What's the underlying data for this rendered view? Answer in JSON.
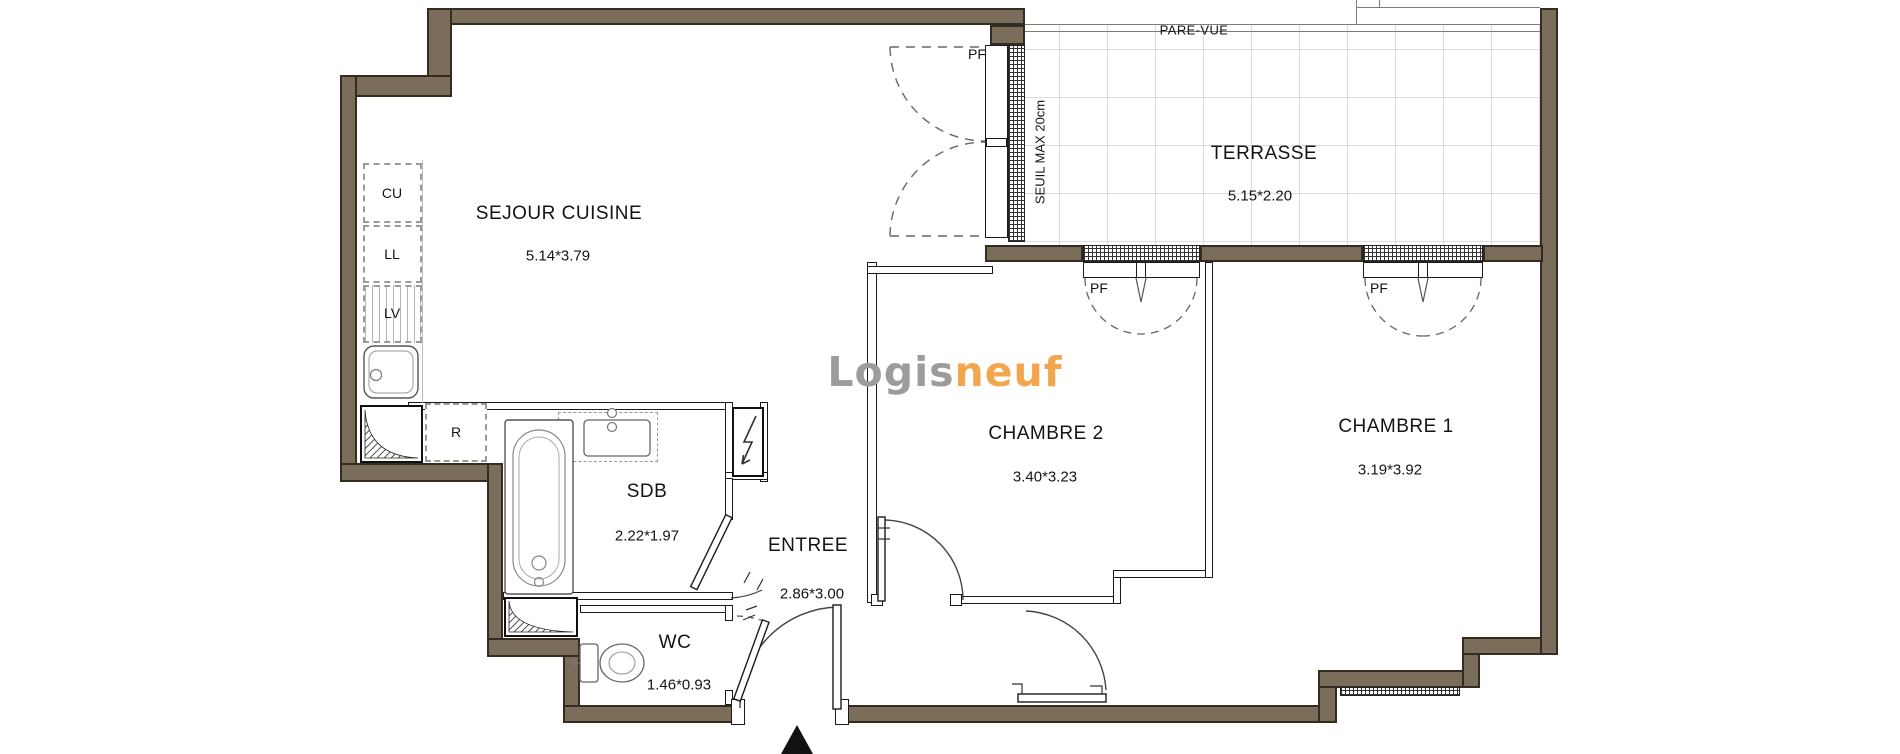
{
  "title": "Floor plan",
  "logo": {
    "part1": "Logis",
    "part2": "neuf",
    "color_gray": "#9c9c9a",
    "color_orange": "#f2a74e"
  },
  "rooms": [
    {
      "id": "sejour",
      "name": "SEJOUR CUISINE",
      "dims": "5.14*3.79"
    },
    {
      "id": "terrasse",
      "name": "TERRASSE",
      "dims": "5.15*2.20"
    },
    {
      "id": "chambre2",
      "name": "CHAMBRE 2",
      "dims": "3.40*3.23"
    },
    {
      "id": "chambre1",
      "name": "CHAMBRE 1",
      "dims": "3.19*3.92"
    },
    {
      "id": "sdb",
      "name": "SDB",
      "dims": "2.22*1.97"
    },
    {
      "id": "entree",
      "name": "ENTREE",
      "dims": "2.86*3.00"
    },
    {
      "id": "wc",
      "name": "WC",
      "dims": "1.46*0.93"
    }
  ],
  "annotations": {
    "pare_vue": "PARE-VUE",
    "seuil": "SEUIL MAX 20cm",
    "pf": "PF"
  },
  "appliances": {
    "cu": "CU",
    "ll": "LL",
    "lv": "LV",
    "r": "R"
  },
  "colors": {
    "wall": "#7a6e5b",
    "wall_edge": "#352c21",
    "tile_grid": "#dcdcdc"
  },
  "icons": [
    "north-arrow-icon",
    "lightning-icon",
    "bathtub-icon",
    "toilet-icon",
    "sink-icon",
    "washbasin-icon",
    "radiator-icon"
  ]
}
